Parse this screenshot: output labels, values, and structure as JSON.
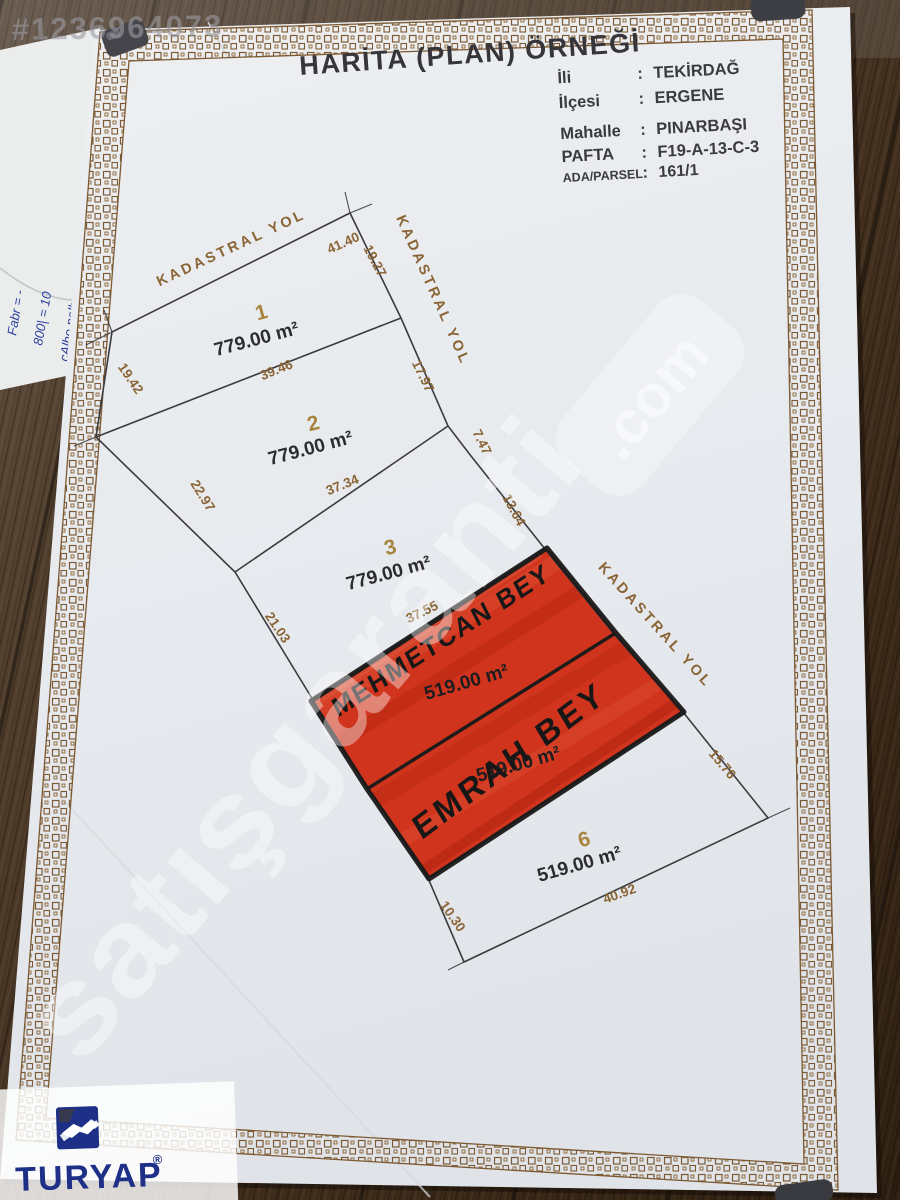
{
  "photo": {
    "listing_id_watermark": "#1236964073",
    "site_watermark": "satışgaranti",
    "site_watermark_domain": ".com",
    "agency_logo_text": "TURYAP",
    "agency_logo_reg": "®",
    "handwritten_note_lines": [
      "Fabr = -",
      "800| = 10",
      "çAlho nolbs = 2500"
    ]
  },
  "document": {
    "title": "HARİTA (PLAN) ÖRNEĞİ",
    "sep": ":",
    "fields": [
      {
        "label": "İli",
        "value": "TEKİRDAĞ"
      },
      {
        "label": "İlçesi",
        "value": "ERGENE"
      },
      {
        "label": "Mahalle",
        "value": "PINARBAŞI"
      },
      {
        "label": "PAFTA",
        "value": "F19-A-13-C-3"
      },
      {
        "label": "ADA/PARSEL",
        "value": "161/1"
      }
    ]
  },
  "plan": {
    "road_label": "KADASTRAL YOL",
    "parcels": [
      {
        "no": "1",
        "area": "779.00 m²",
        "highlighted": false
      },
      {
        "no": "2",
        "area": "779.00 m²",
        "highlighted": false
      },
      {
        "no": "3",
        "area": "779.00 m²",
        "highlighted": false
      },
      {
        "area": "519.00 m²",
        "owner_note": "MEHMETCAN BEY",
        "highlighted": true
      },
      {
        "area": "519.00 m²",
        "owner_note": "EMRAH BEY",
        "highlighted": true
      },
      {
        "no": "6",
        "area": "519.00 m²",
        "highlighted": false
      }
    ],
    "measurements": {
      "m4140": "41.40",
      "m1927": "19.27",
      "m1942": "19.42",
      "m3946": "39.46",
      "m1797": "17.97",
      "m2297": "22.97",
      "m3734": "37.34",
      "m747": "7.47",
      "m1364": "13.64",
      "m2103": "21.03",
      "m3755": "37.55",
      "m1576": "15.76",
      "m1030": "10.30",
      "m4092": "40.92"
    }
  },
  "colors": {
    "highlight_red": "#d0341d",
    "border_brown": "#7d5a33",
    "plan_text_brown": "#8a6434",
    "ink_black": "#1a1a1a",
    "brand_blue": "#1d2f87",
    "note_ink_blue": "#2b3fa0",
    "paper": "#e9ecef"
  }
}
